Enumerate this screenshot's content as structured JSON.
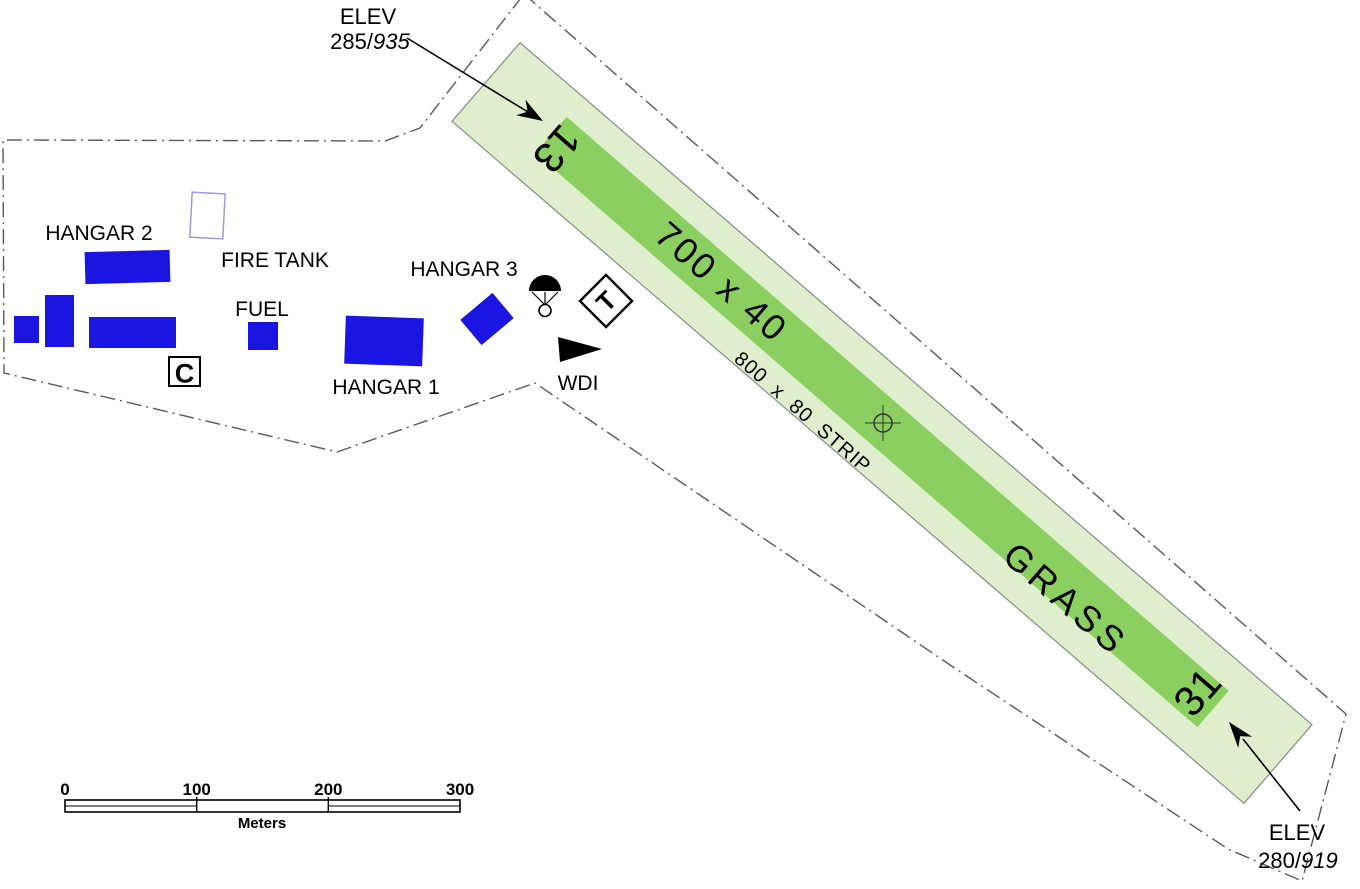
{
  "map": {
    "elev_nw": {
      "title": "ELEV",
      "value": "285/",
      "value_alt": "935"
    },
    "elev_se": {
      "title": "ELEV",
      "value": "280/",
      "value_alt": "919"
    },
    "runway": {
      "designator_nw": "13",
      "designator_se": "31",
      "dimensions": "700 x 40",
      "strip_label": "800 x 80 STRIP",
      "surface": "GRASS"
    },
    "buildings": {
      "hangar_1": "HANGAR 1",
      "hangar_2": "HANGAR 2",
      "hangar_3": "HANGAR 3",
      "fire_tank": "FIRE TANK",
      "fuel": "FUEL"
    },
    "symbols": {
      "wdi_label": "WDI",
      "boxed_c": "C",
      "boxed_t": "T"
    },
    "scalebar": {
      "ticks": [
        "0",
        "100",
        "200",
        "300"
      ],
      "unit_label": "Meters"
    },
    "colors": {
      "strip_fill": "#dfeecd",
      "runway_fill": "#8ccf61",
      "building_fill": "#1a15e0",
      "fire_tank_stroke": "#9a9ae0",
      "boundary_stroke": "#5a5a5a",
      "strip_outline": "#8a8a8a"
    }
  }
}
